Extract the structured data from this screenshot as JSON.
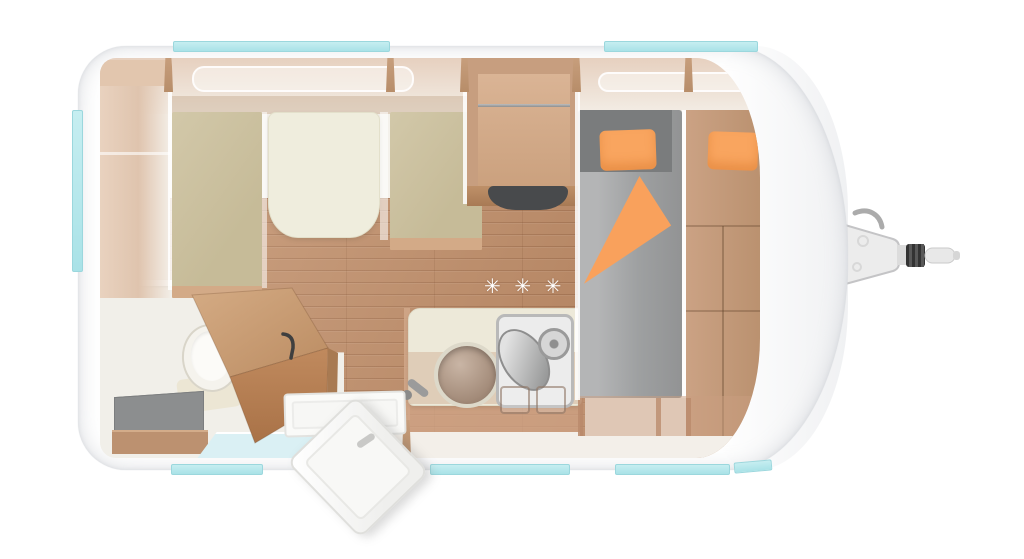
{
  "meta": {
    "title": "Caravan floor plan — top view",
    "view": "top-down 3D cutaway render",
    "text_visible": false
  },
  "floor_marks": {
    "heating_symbols": "✳ ✳ ✳",
    "symbol_glyph": "eight-spoked-asterisk",
    "count": 3
  },
  "palette": {
    "body_white": "#FFFFFF",
    "outline_gray": "#D8DADE",
    "window_glass_cyan": "#AEE4E9",
    "wood_floor": "#BC8B67",
    "furniture_wood": "#C79E7F",
    "furniture_wood_dark": "#A87A52",
    "cushion_khaki": "#CBC09F",
    "table_cream": "#EFEDDD",
    "counter_cream": "#EDE9D9",
    "mattress_gray": "#9EA0A1",
    "headboard_gray": "#7A7C7D",
    "bedding_orange": "#F9A35E",
    "shower_blue": "#DAF0F4",
    "appliance_dark": "#484A4C",
    "hitch_metal": "#ECECEC"
  },
  "components": {
    "exterior": [
      "caravan-body",
      "tow-hitch",
      "entry-door-open",
      "roof-skylights",
      "window-strips-top",
      "window-strip-rear",
      "window-strips-bottom"
    ],
    "dinette": [
      "sideboard",
      "bench-seat-left",
      "bench-seat-right",
      "dinette-table"
    ],
    "kitchen": [
      "tall-cabinet",
      "dark-appliance",
      "countertop",
      "round-sink",
      "faucet",
      "stove-with-lid",
      "hob-burners",
      "base-cabinet"
    ],
    "bathroom": [
      "toilet",
      "step-stool",
      "shower-tray",
      "bathroom-door-open"
    ],
    "bedroom": [
      "headboard",
      "mattress",
      "pillow-left",
      "pillow-right",
      "folded-blanket",
      "wardrobe",
      "bed-bench"
    ],
    "floor": [
      "wood-plank-floor",
      "heating-vent-symbols"
    ]
  }
}
